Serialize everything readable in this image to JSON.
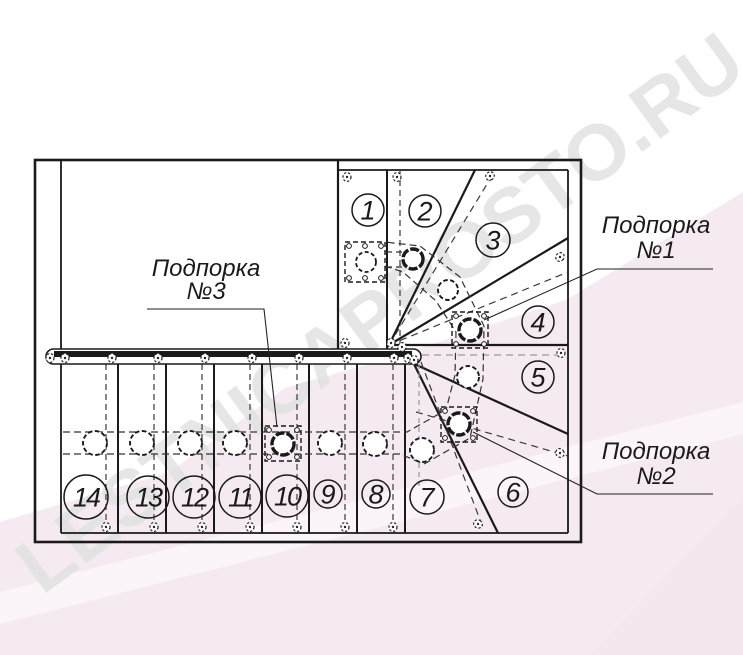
{
  "watermark": {
    "text": "LESTNICAPROSTO.RU",
    "text_color": "#e2e2e2",
    "pink_color": "#f6eaf2",
    "band_color": "#fbf4f9"
  },
  "drawing": {
    "title": "Staircase plan with winders",
    "colors": {
      "line": "#1a1a1a",
      "dash": "#3a3a3a",
      "gray": "#999999"
    },
    "steps": [
      {
        "label": "1",
        "x": 368,
        "y": 210,
        "r": 16
      },
      {
        "label": "2",
        "x": 425,
        "y": 211,
        "r": 16
      },
      {
        "label": "3",
        "x": 493,
        "y": 240,
        "r": 17
      },
      {
        "label": "4",
        "x": 538,
        "y": 322,
        "r": 16
      },
      {
        "label": "5",
        "x": 538,
        "y": 377,
        "r": 16
      },
      {
        "label": "6",
        "x": 513,
        "y": 492,
        "r": 15
      },
      {
        "label": "7",
        "x": 427,
        "y": 497,
        "r": 17
      },
      {
        "label": "8",
        "x": 376,
        "y": 494,
        "r": 14
      },
      {
        "label": "9",
        "x": 328,
        "y": 494,
        "r": 14
      },
      {
        "label": "10",
        "x": 287,
        "y": 496,
        "r": 21
      },
      {
        "label": "11",
        "x": 240,
        "y": 497,
        "r": 21
      },
      {
        "label": "12",
        "x": 194,
        "y": 497,
        "r": 21
      },
      {
        "label": "13",
        "x": 148,
        "y": 497,
        "r": 21
      },
      {
        "label": "14",
        "x": 86,
        "y": 497,
        "r": 22
      }
    ],
    "supports": [
      {
        "line1": "Подпорка",
        "line2": "№1",
        "tx": 656,
        "ty1": 233,
        "ty2": 258,
        "leader": "713,269 597,269 484,320",
        "sq": [
          452,
          312,
          36,
          36
        ],
        "post": [
          470,
          330,
          11
        ]
      },
      {
        "line1": "Подпорка",
        "line2": "№2",
        "tx": 656,
        "ty1": 459,
        "ty2": 484,
        "leader": "713,494 597,494 473,432",
        "sq": [
          441,
          407,
          36,
          35
        ],
        "post": [
          459,
          424,
          11
        ]
      },
      {
        "line1": "Подпорка",
        "line2": "№3",
        "tx": 206,
        "ty1": 276,
        "ty2": 299,
        "leader": "147,309 264,309 277,427",
        "sq": [
          265,
          426,
          36,
          35
        ],
        "post": [
          283,
          444,
          11
        ]
      }
    ],
    "newel_post": {
      "sq": [
        345,
        242,
        40,
        40
      ],
      "baluster": [
        366,
        262,
        10
      ],
      "post": [
        413,
        259,
        10
      ]
    },
    "balusters": [
      [
        95,
        443,
        12
      ],
      [
        142,
        443,
        12
      ],
      [
        190,
        443,
        12
      ],
      [
        235,
        443,
        12
      ],
      [
        330,
        443,
        12
      ],
      [
        375,
        444,
        12
      ],
      [
        422,
        450,
        12
      ],
      [
        468,
        377,
        11
      ],
      [
        448,
        290,
        10
      ]
    ],
    "wall_glyphs": [
      [
        347,
        177,
        0
      ],
      [
        397,
        177,
        0
      ],
      [
        490,
        176,
        55
      ],
      [
        560,
        257,
        35
      ],
      [
        561,
        353,
        0
      ],
      [
        560,
        453,
        -35
      ],
      [
        478,
        524,
        -60
      ],
      [
        106,
        527,
        0
      ],
      [
        154,
        527,
        0
      ],
      [
        202,
        527,
        0
      ],
      [
        250,
        527,
        0
      ],
      [
        297,
        527,
        0
      ],
      [
        345,
        527,
        0
      ],
      [
        393,
        527,
        0
      ],
      [
        50,
        358,
        0
      ],
      [
        65,
        358,
        0
      ],
      [
        112,
        358,
        0
      ],
      [
        158,
        358,
        0
      ],
      [
        205,
        358,
        0
      ],
      [
        252,
        358,
        0
      ],
      [
        299,
        358,
        0
      ],
      [
        347,
        358,
        0
      ],
      [
        394,
        358,
        0
      ],
      [
        408,
        358,
        0
      ],
      [
        345,
        343,
        0
      ],
      [
        391,
        343,
        0
      ],
      [
        402,
        347,
        30
      ],
      [
        414,
        360,
        0
      ]
    ]
  }
}
